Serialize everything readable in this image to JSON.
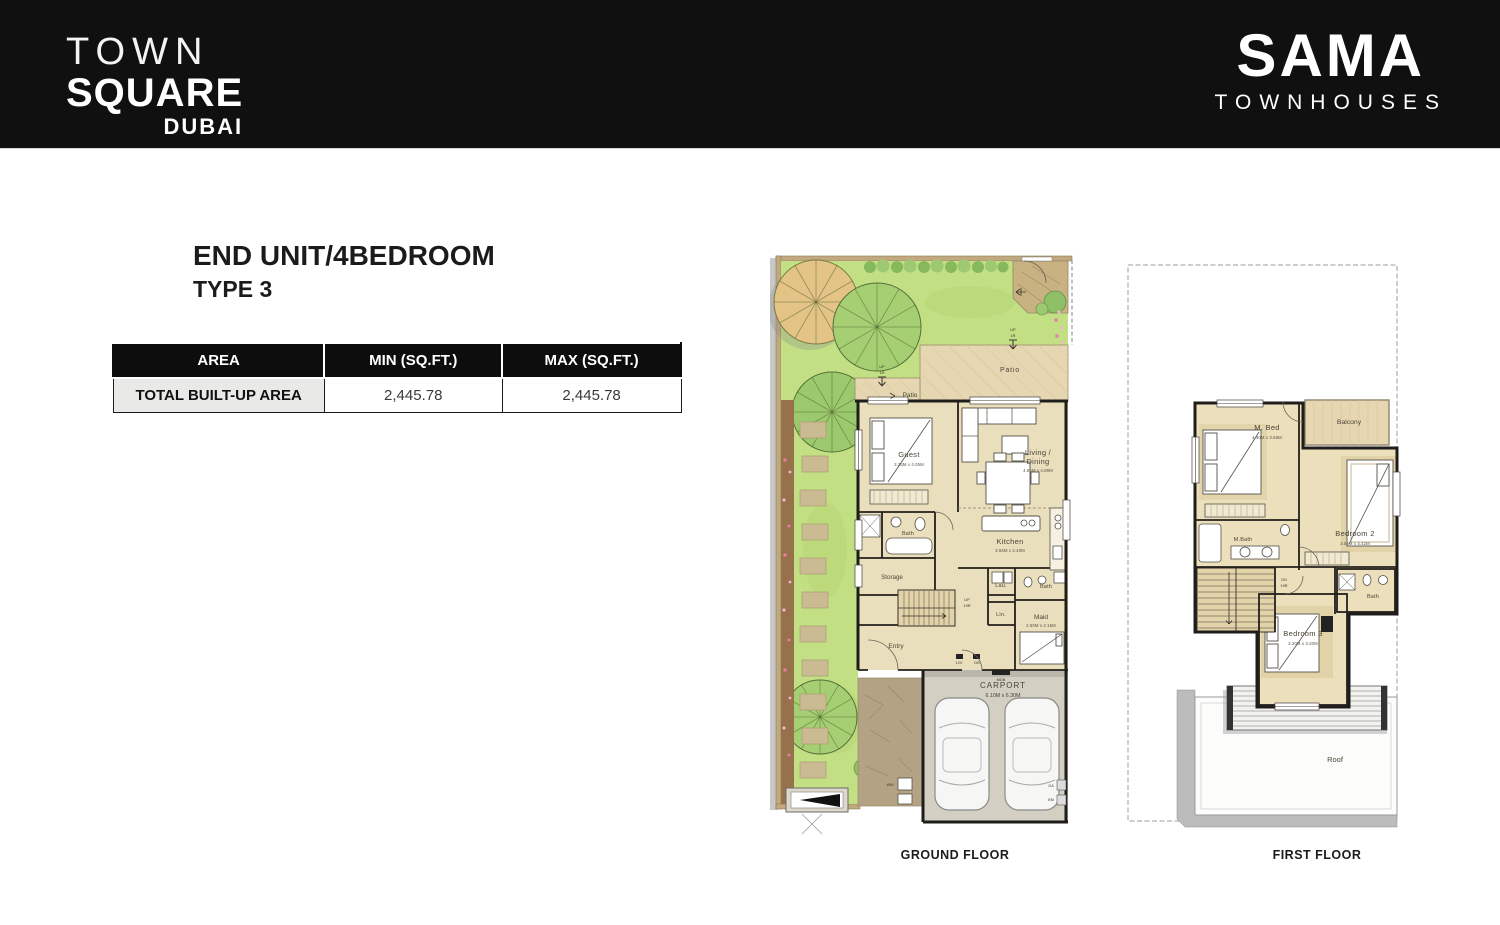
{
  "header": {
    "logo_left": {
      "line1": "TOWN",
      "line2": "SQUARE",
      "line3": "DUBAI"
    },
    "logo_right": {
      "line1": "SAMA",
      "line2": "TOWNHOUSES"
    }
  },
  "title": {
    "line1": "END UNIT/4BEDROOM",
    "line2": "TYPE 3"
  },
  "area_table": {
    "col_area": "AREA",
    "col_min": "MIN (SQ.FT.)",
    "col_max": "MAX (SQ.FT.)",
    "row_label": "TOTAL BUILT-UP AREA",
    "row_min": "2,445.78",
    "row_max": "2,445.78"
  },
  "ground_floor": {
    "caption": "GROUND FLOOR",
    "up": "UP",
    "one_r": "1R",
    "patio": "Patio",
    "guest": {
      "name": "Guest",
      "dim": "3.25M x 4.05M"
    },
    "living": {
      "name1": "Living /",
      "name2": "Dining",
      "dim": "4.85M x 4.89M"
    },
    "kitchen": {
      "name": "Kitchen",
      "dim": "3.56M x 2.40M"
    },
    "bath": "Bath",
    "storage": "Storage",
    "stairs": {
      "dir": "UP",
      "steps": "19R"
    },
    "lau": "Lau.",
    "lin": "Lin.",
    "maid": {
      "name": "Maid",
      "dim": "2.50M x 2.15M"
    },
    "maid_bath": "Bath",
    "entry": "Entry",
    "twelve_v": "12V",
    "db": "DB",
    "mdb": "MDB",
    "wm": "WM",
    "ga": "GA",
    "em": "EM",
    "carport": {
      "name": "CARPORT",
      "dim": "6.10M x 6.30M"
    }
  },
  "first_floor": {
    "caption": "FIRST FLOOR",
    "mbed": {
      "name": "M. Bed",
      "dim": "4.40M x 3.65M"
    },
    "balcony": "Balcony",
    "bedroom2": {
      "name": "Bedroom 2",
      "dim": "3.55M x 4.42M"
    },
    "mbath": "M.Bath",
    "stairs": {
      "dir": "DN",
      "steps": "19R"
    },
    "bath": "Bath",
    "bedroom3": {
      "name": "Bedroom 3",
      "dim": "3.30M x 3.20M"
    },
    "roof": "Roof"
  },
  "colors": {
    "header_bg": "#101010",
    "lawn": "#c2df84",
    "floor": "#eadfbc",
    "patio": "#e6d7b2",
    "carport": "#d3d0c3",
    "wall": "#1f1d1a"
  }
}
